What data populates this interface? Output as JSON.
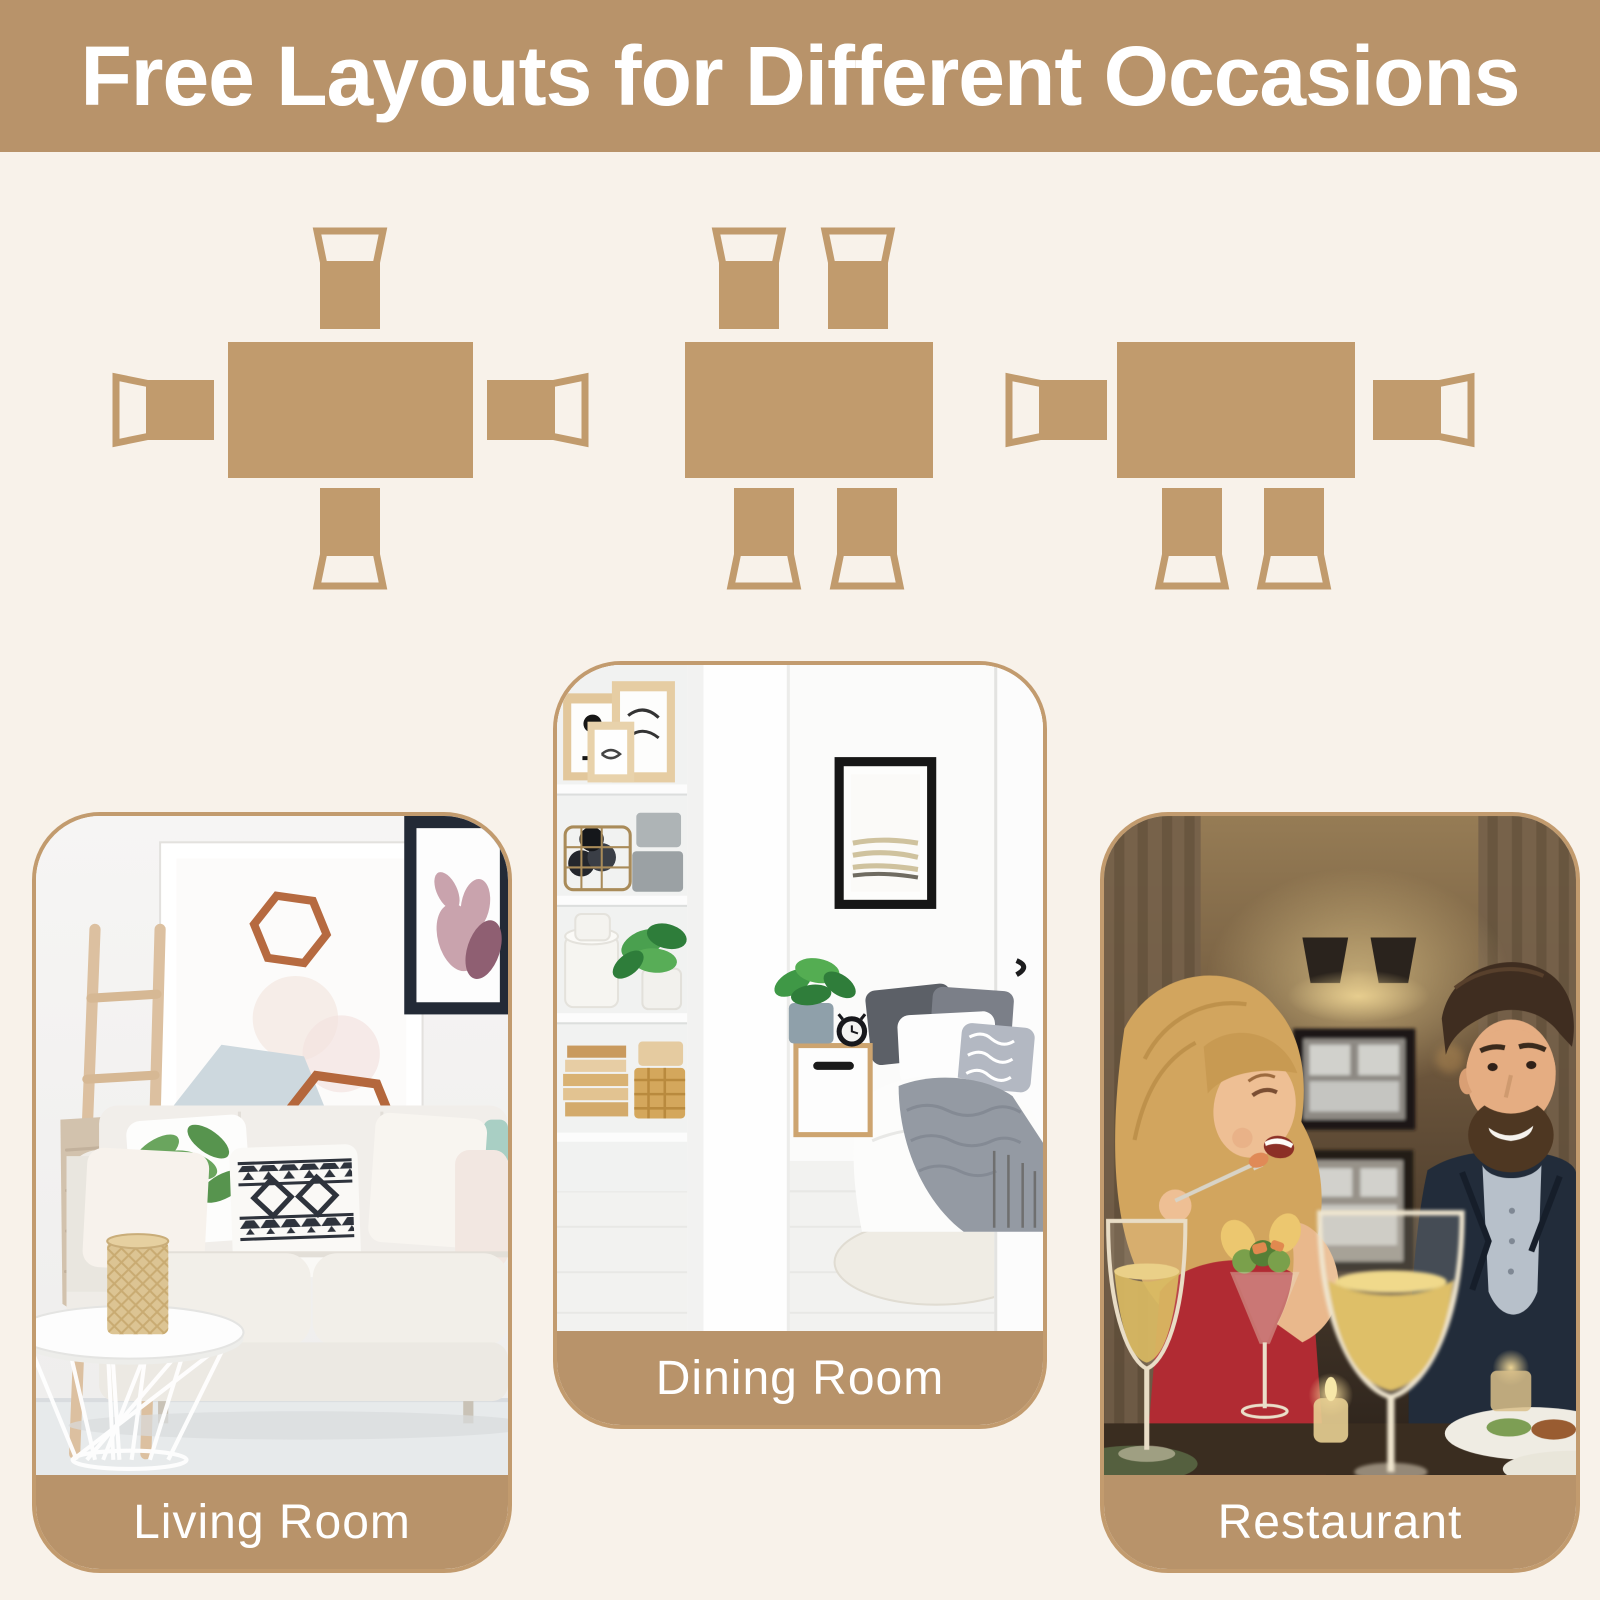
{
  "colors": {
    "page_background": "#F8F2EA",
    "accent_tan": "#B8936A",
    "diagram_tan": "#C19B6D",
    "card_border": "#C29B6E",
    "label_text": "#FFFFFF"
  },
  "header": {
    "title": "Free Layouts for Different Occasions"
  },
  "layout_diagrams": [
    {
      "icon": "table-with-one-chair-on-each-side-icon",
      "chairs": 4
    },
    {
      "icon": "table-with-two-chairs-top-and-two-bottom-icon",
      "chairs": 4
    },
    {
      "icon": "table-with-left-right-and-two-bottom-chairs-icon",
      "chairs": 4
    }
  ],
  "cards": [
    {
      "label": "Living Room"
    },
    {
      "label": "Dining Room"
    },
    {
      "label": "Restaurant"
    }
  ]
}
